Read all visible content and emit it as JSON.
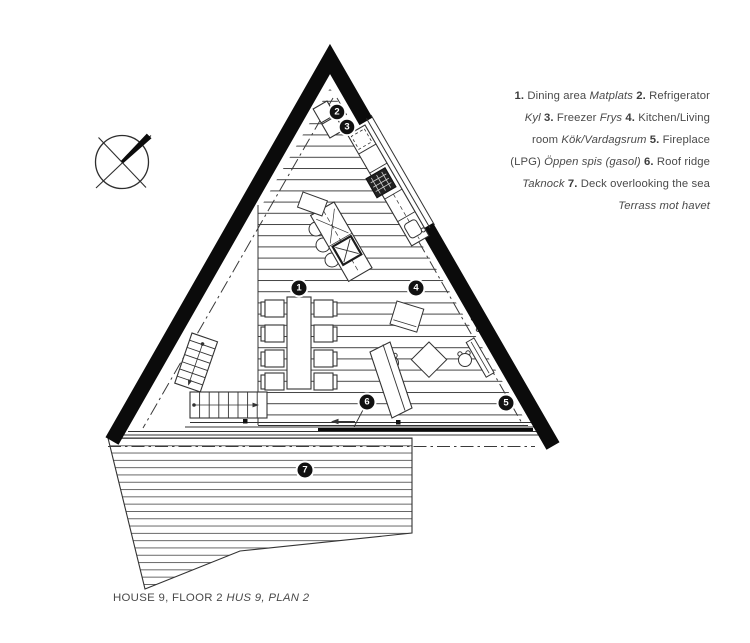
{
  "legend": {
    "lines": [
      {
        "segments": [
          {
            "t": "1. "
          },
          {
            "t": "Dining area "
          },
          {
            "t": "Matplats "
          },
          {
            "t": "2. "
          },
          {
            "t": "Refrigerator"
          }
        ]
      },
      {
        "segments": [
          {
            "t": "Kyl "
          },
          {
            "t": "3. "
          },
          {
            "t": "Freezer "
          },
          {
            "t": "Frys "
          },
          {
            "t": "4. "
          },
          {
            "t": "Kitchen/Living"
          }
        ]
      },
      {
        "segments": [
          {
            "t": "room "
          },
          {
            "t": "Kök/Vardagsrum "
          },
          {
            "t": "5. "
          },
          {
            "t": "Fireplace"
          }
        ]
      },
      {
        "segments": [
          {
            "t": "(LPG) "
          },
          {
            "t": "Öppen spis (gasol) "
          },
          {
            "t": "6. "
          },
          {
            "t": "Roof ridge"
          }
        ]
      },
      {
        "segments": [
          {
            "t": "Taknock "
          },
          {
            "t": "7. "
          },
          {
            "t": "Deck overlooking the sea"
          }
        ]
      },
      {
        "segments": [
          {
            "t": "Terrass mot havet"
          }
        ]
      }
    ]
  },
  "caption": {
    "regular": "HOUSE 9, FLOOR 2 ",
    "italic": "HUS 9, PLAN 2"
  },
  "plan": {
    "badges": [
      {
        "n": "1"
      },
      {
        "n": "2"
      },
      {
        "n": "3"
      },
      {
        "n": "4"
      },
      {
        "n": "5"
      },
      {
        "n": "6"
      },
      {
        "n": "7"
      }
    ],
    "icons": {
      "compass": "north-arrow-compass",
      "stairs_arrows": "stair-direction-arrows",
      "ridge_arrow": "left-arrow"
    },
    "colors": {
      "wall": "#0b0b0b",
      "line": "#333333",
      "hatch": "#454545",
      "badge": "#111111",
      "text": "#4a4a4a",
      "background": "#ffffff"
    }
  }
}
